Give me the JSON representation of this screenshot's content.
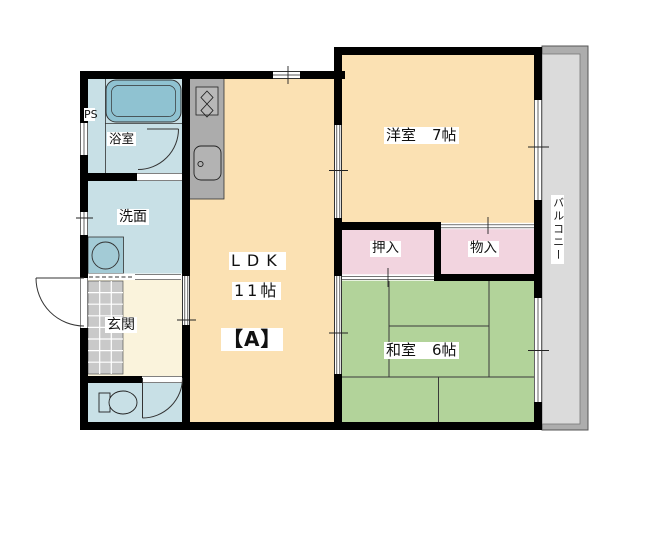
{
  "plan": {
    "unit_label": "【A】",
    "rooms": {
      "ldk": {
        "name": "LDK",
        "area": "11帖"
      },
      "western_room": {
        "name": "洋室",
        "area": "7帖"
      },
      "japanese_room": {
        "name": "和室",
        "area": "6帖"
      },
      "closet": {
        "name": "押入"
      },
      "storage": {
        "name": "物入"
      },
      "bathroom": {
        "name": "浴室"
      },
      "washroom": {
        "name": "洗面"
      },
      "entrance": {
        "name": "玄関"
      },
      "balcony": {
        "name": "バルコニー"
      },
      "pipe_space": {
        "name": "PS"
      }
    },
    "colors": {
      "flooring_peach": "#FBE1B3",
      "tatami_green": "#B2D39A",
      "closet_pink": "#F2D4DF",
      "wet_area_blue": "#C8E0E6",
      "bathtub_blue": "#8FC2D1",
      "entrance_cream": "#FAF3DC",
      "tile_gray": "#C9C9C9",
      "counter_gray": "#ACACAC",
      "balcony_gray": "#DBDBDB",
      "wall_black": "#000000"
    }
  }
}
